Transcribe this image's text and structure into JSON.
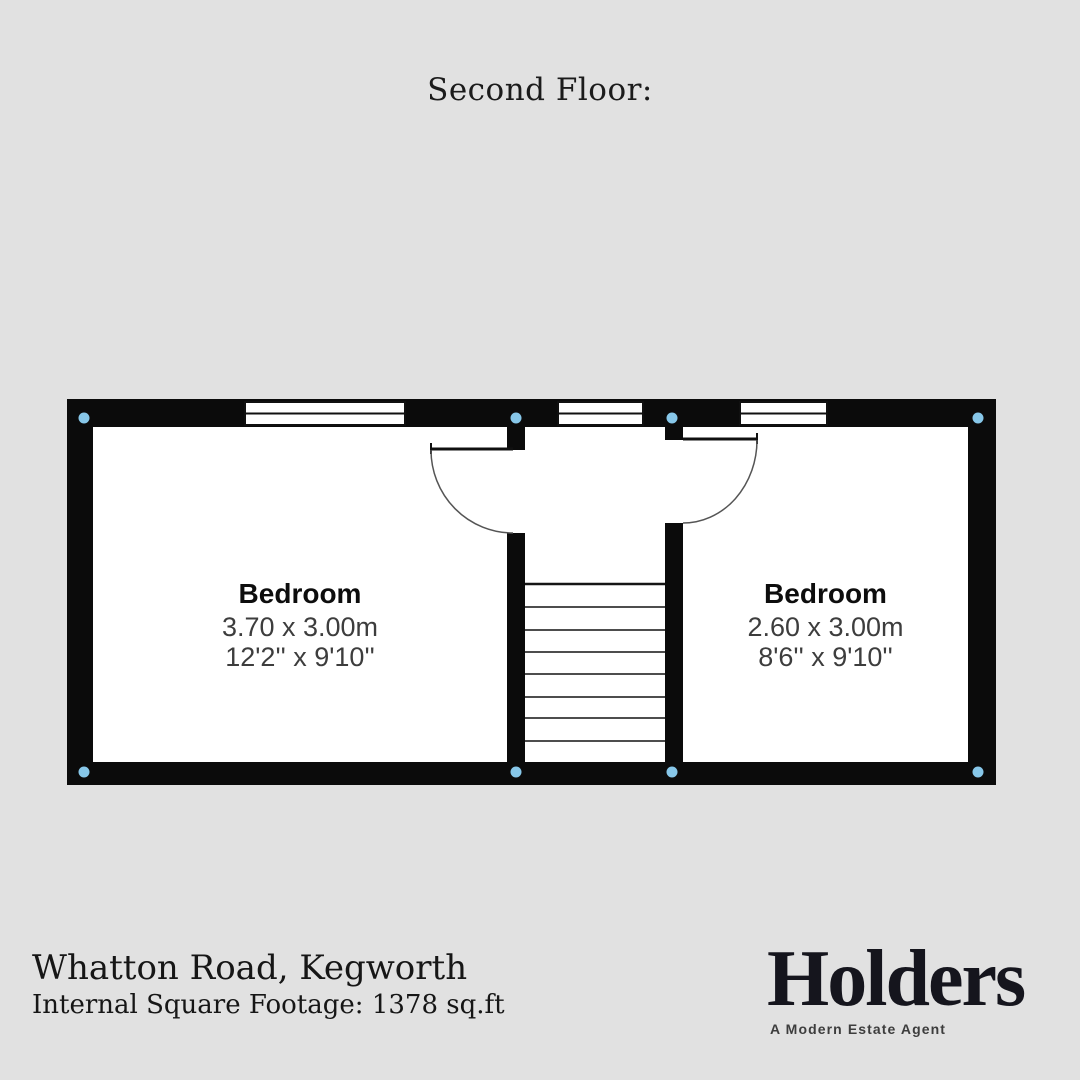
{
  "title": "Second Floor:",
  "floorplan": {
    "rooms": [
      {
        "name": "Bedroom",
        "metric": "3.70 x 3.00m",
        "imperial": "12'2'' x 9'10''"
      },
      {
        "name": "Bedroom",
        "metric": "2.60 x 3.00m",
        "imperial": "8'6'' x 9'10''"
      }
    ],
    "stair_step_lines": 8,
    "window_count": 3,
    "corner_marker_count": 8,
    "colors": {
      "background": "#e1e1e1",
      "wall": "#0b0b0b",
      "floor": "#ffffff",
      "corner_marker": "#87c7e9"
    }
  },
  "footer": {
    "address": "Whatton Road, Kegworth",
    "square_footage": "Internal Square Footage: 1378 sq.ft"
  },
  "logo": {
    "brand": "Holders",
    "tagline": "A Modern Estate Agent"
  }
}
